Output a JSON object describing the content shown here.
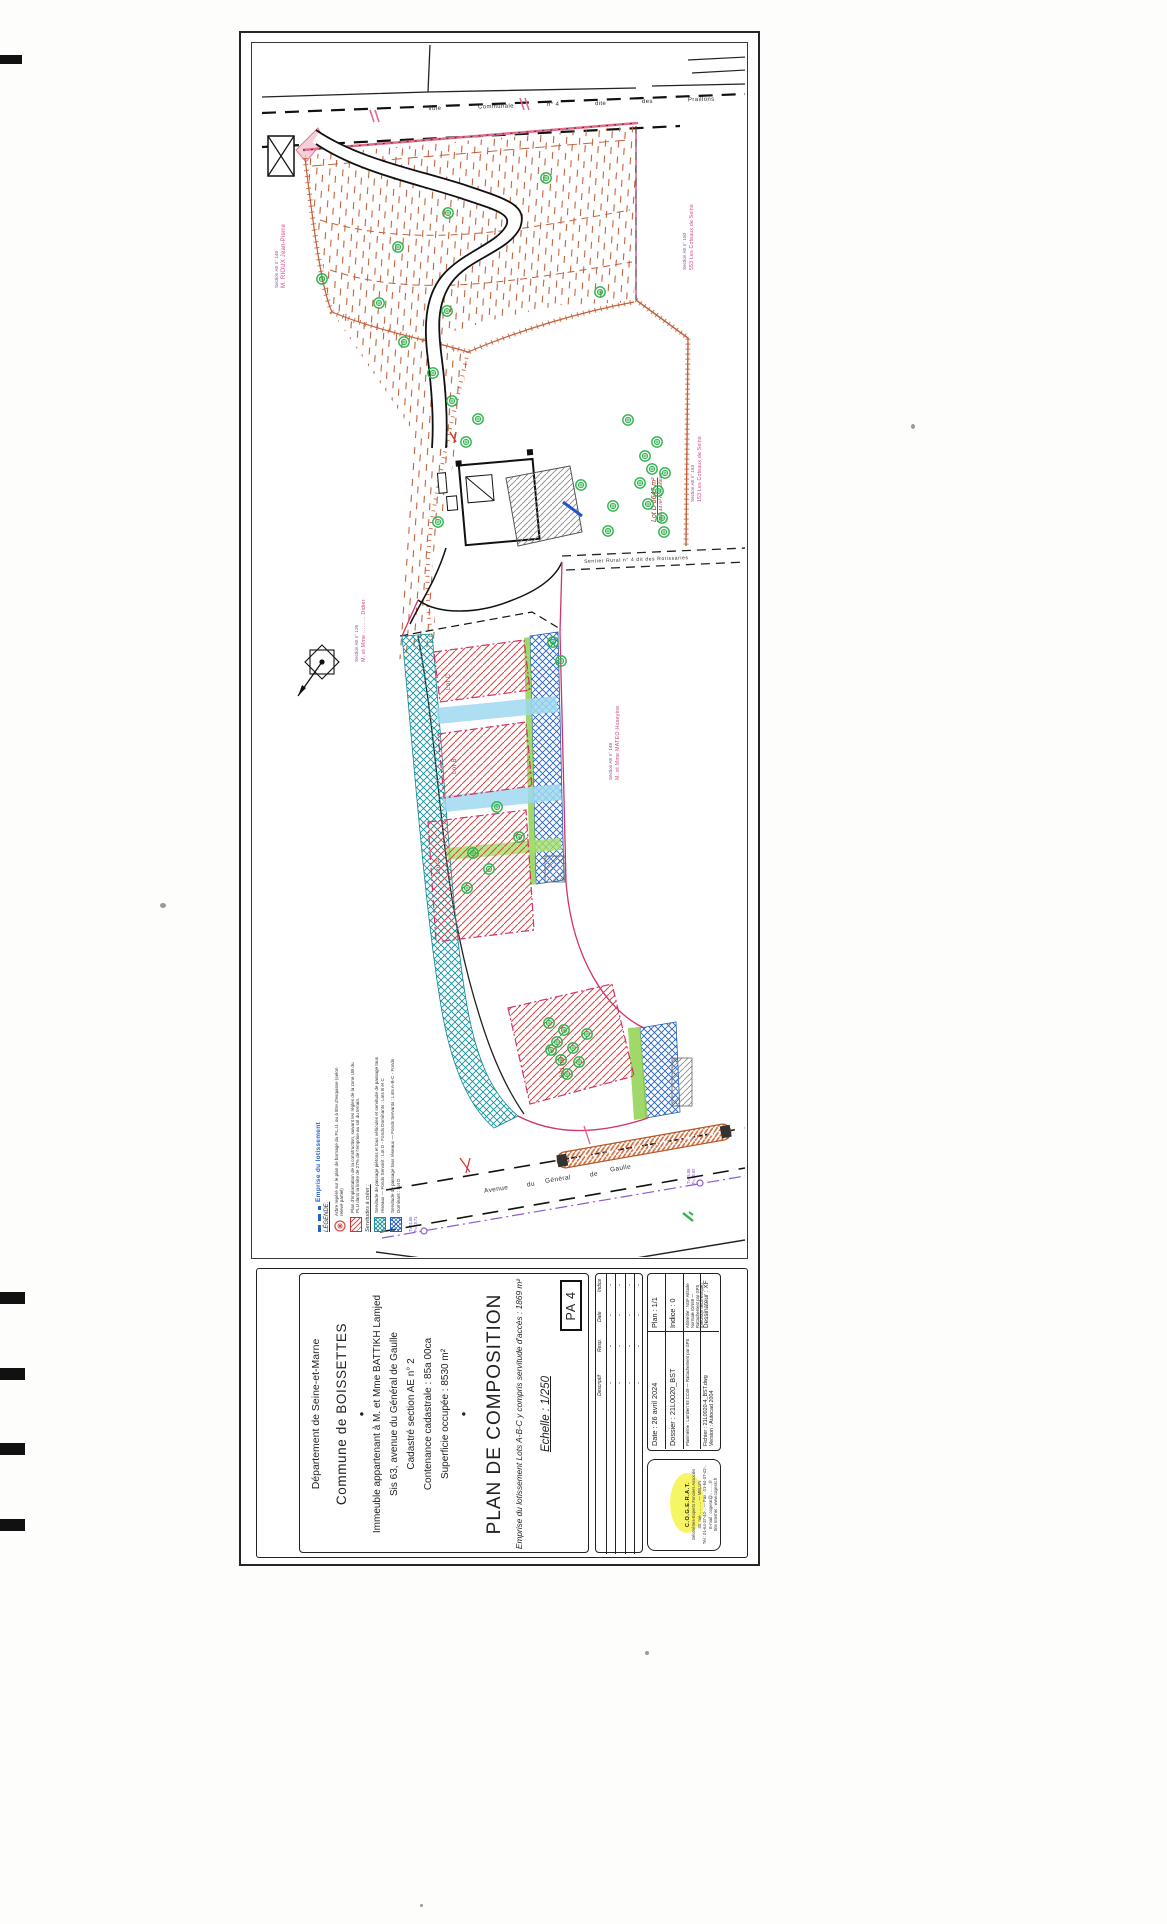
{
  "plan": {
    "road_top": {
      "w0": "Voie",
      "w1": "Communale",
      "w2": "n° 4",
      "w3": "dite",
      "w4": "des",
      "w5": "Praillons"
    },
    "avenue": {
      "w0": "Avenue",
      "w1": "du",
      "w2": "Général",
      "w3": "de",
      "w4": "Gaulle"
    },
    "sentier": "Sentier   Rural   n° 4   dit   des   Rotissaries",
    "neighbors": {
      "left_section": "Section AE n° 145",
      "left_name": "M. RIOUX Jean-Pierre",
      "rt_section": "Section AE n° 150",
      "rt_name": "553 Les Coteaux de Seine",
      "rm_section": "Section AE n° 153",
      "rm_name": "153 Les Coteaux de Seine",
      "mid_section": "Section AE n° 126",
      "mid_name": "M. et Mme ……… Didier",
      "rl_section": "Section AE n° 148",
      "rl_name": "M. et Mme MATEO Huseyine"
    },
    "lot_d_title": "Lot D  6647 m²",
    "lot_d_sub": "dont 44 m² hors clôture",
    "lot_a": "Lot A",
    "lot_b": "Lot B",
    "lot_c": "Lot C",
    "lot_area": "921 m²",
    "nl1": "T=74.56",
    "nl2": "F=73.71",
    "nr1": "T=75.06",
    "nr2": "F=73.52"
  },
  "legend": {
    "emprise": "Emprise du lotissement",
    "title": "LÉGENDE:",
    "tree": "Arbre repéré sur le plan de bornage du P.L.U. ou à titre d'esquisse (selon relevé partiel)",
    "implantation": "Plan d'implantation de la construction, suivant les règles de la zone UB du PLU dans la limite de 27% de l'emprise au sol du terrain.",
    "servitudes": "Servitudes à créer :",
    "teal": "Servitude de passage piétons et tous véhicules et servitude de passage tous réseaux — Fonds Servant : Lot D - Fonds Dominants : Lots B et C",
    "blue": "Servitude de passage tous réseaux — Fonds Servants : Lots A-B-C - Fonds Dominant : Lot D"
  },
  "title_block": {
    "department": "Département de Seine-et-Marne",
    "commune": "Commune de BOISSETTES",
    "bullet": "●",
    "line1": "Immeuble appartenant à M. et Mme BATTIKH Lamjed",
    "line2": "Sis 63, avenue du Général de Gaulle",
    "line3": "Cadastré section AE n° 2",
    "line4": "Contenance cadastrale : 85a 00ca",
    "line5": "Superficie occupée : 8530 m²",
    "title": "PLAN DE COMPOSITION",
    "subtitle": "Emprise du lotissement Lots A-B-C y compris servitude d'accès : 1869 m²",
    "scale": "Echelle : 1/250",
    "ref": "PA 4",
    "revisions": {
      "h0": "Descriptif",
      "h1": "Resp.",
      "h2": "Date",
      "h3": "Indice",
      "cell": "-"
    },
    "info": {
      "date": "Date :   26 avril 2024",
      "plan": "Plan : 1/1",
      "dossier": "Dossier : 21L0020_BST",
      "indice": "Indice : 0",
      "plani": "Planimétrie : Lambert 93 CC49 — Rattachement par GPS",
      "alti": "Altimétrie : NGF Altitude Normale IGN69 — Rattachement par GPS (précision décimétrique)",
      "fichier": "Fichier : 21L0020-4_BST.dwg",
      "version": "Version : Autocad 2004",
      "dessinateur": "Dessinateur : XF"
    },
    "firm": {
      "name": "C.O.G.E.R.A.T.",
      "l1": "Géomètres-Experts Fonciers Associés",
      "l2": "30, rue ……… — MELUN",
      "l3": "Tél : 01-64-37-40-.. — Fax : 01-64-37-42-..",
      "l4": "E-mail : cogerat@………fr",
      "l5": "Site Internet : www.cogerat.fr"
    }
  }
}
